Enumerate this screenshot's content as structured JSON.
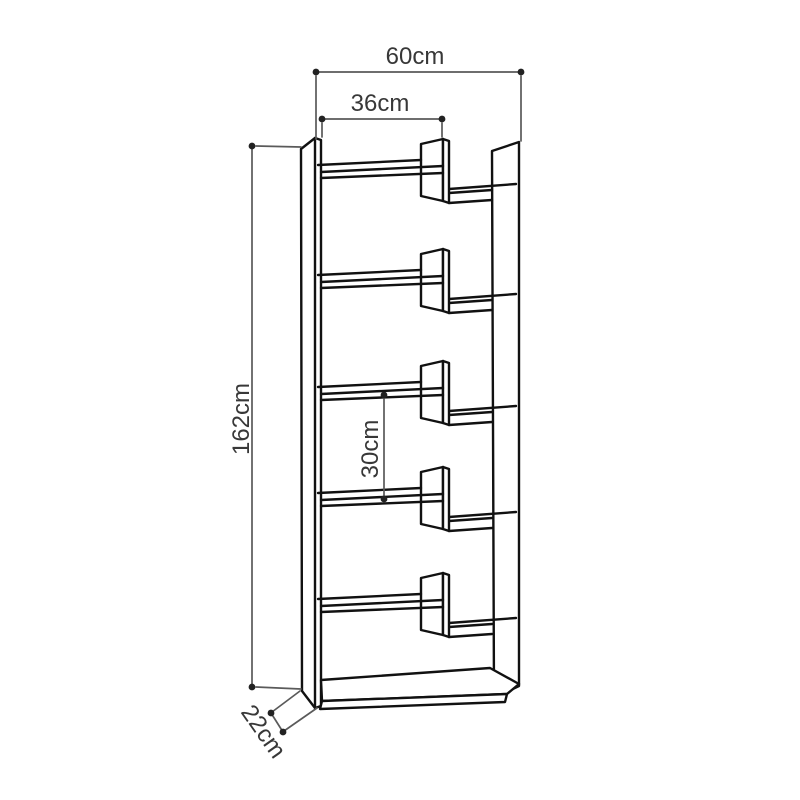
{
  "diagram": {
    "kind": "furniture dimension drawing",
    "product": "staggered open bookcase",
    "background_color": "#ffffff",
    "structure_line_color": "#111111",
    "dimension_line_color": "#5a5a5a",
    "label_color": "#383838",
    "shelf_levels": 5,
    "dimensions": {
      "total_width": {
        "label": "60cm",
        "value_cm": 60,
        "orientation": "horizontal"
      },
      "inner_width": {
        "label": "36cm",
        "value_cm": 36,
        "orientation": "horizontal"
      },
      "total_height": {
        "label": "162cm",
        "value_cm": 162,
        "orientation": "vertical"
      },
      "shelf_gap": {
        "label": "30cm",
        "value_cm": 30,
        "orientation": "vertical"
      },
      "depth": {
        "label": "22cm",
        "value_cm": 22,
        "orientation": "diagonal"
      }
    }
  }
}
